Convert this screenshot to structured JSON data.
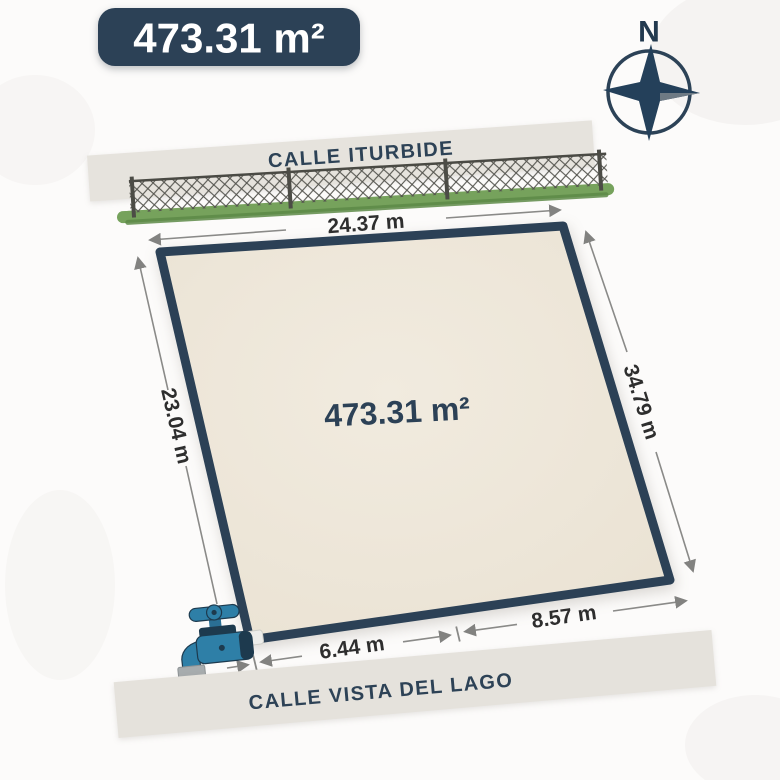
{
  "badge": {
    "area": "473.31 m²"
  },
  "compass": {
    "north": "N"
  },
  "streets": {
    "top": "CALLE ITURBIDE",
    "bottom": "CALLE VISTA DEL LAGO"
  },
  "plot": {
    "area": "473.31 m²",
    "dimensions": {
      "top": "24.37 m",
      "left": "23.04 m",
      "right": "34.79 m",
      "bottom_left": "6.44 m",
      "bottom_right": "8.57 m"
    }
  },
  "icons": {
    "compass": "compass-rose-icon",
    "fence": "chain-link-fence-icon",
    "faucet": "water-tap-icon"
  },
  "colors": {
    "navy": "#2c4156",
    "plot_fill": "#eee7da",
    "street_band": "#e5e2dc",
    "dimension_line": "#8a8a88",
    "dimension_text": "#2e2e2e",
    "fence_green": "#76a25c",
    "faucet_blue": "#2e7fa7",
    "badge_text": "#ffffff",
    "background": "#fcfbfa"
  }
}
